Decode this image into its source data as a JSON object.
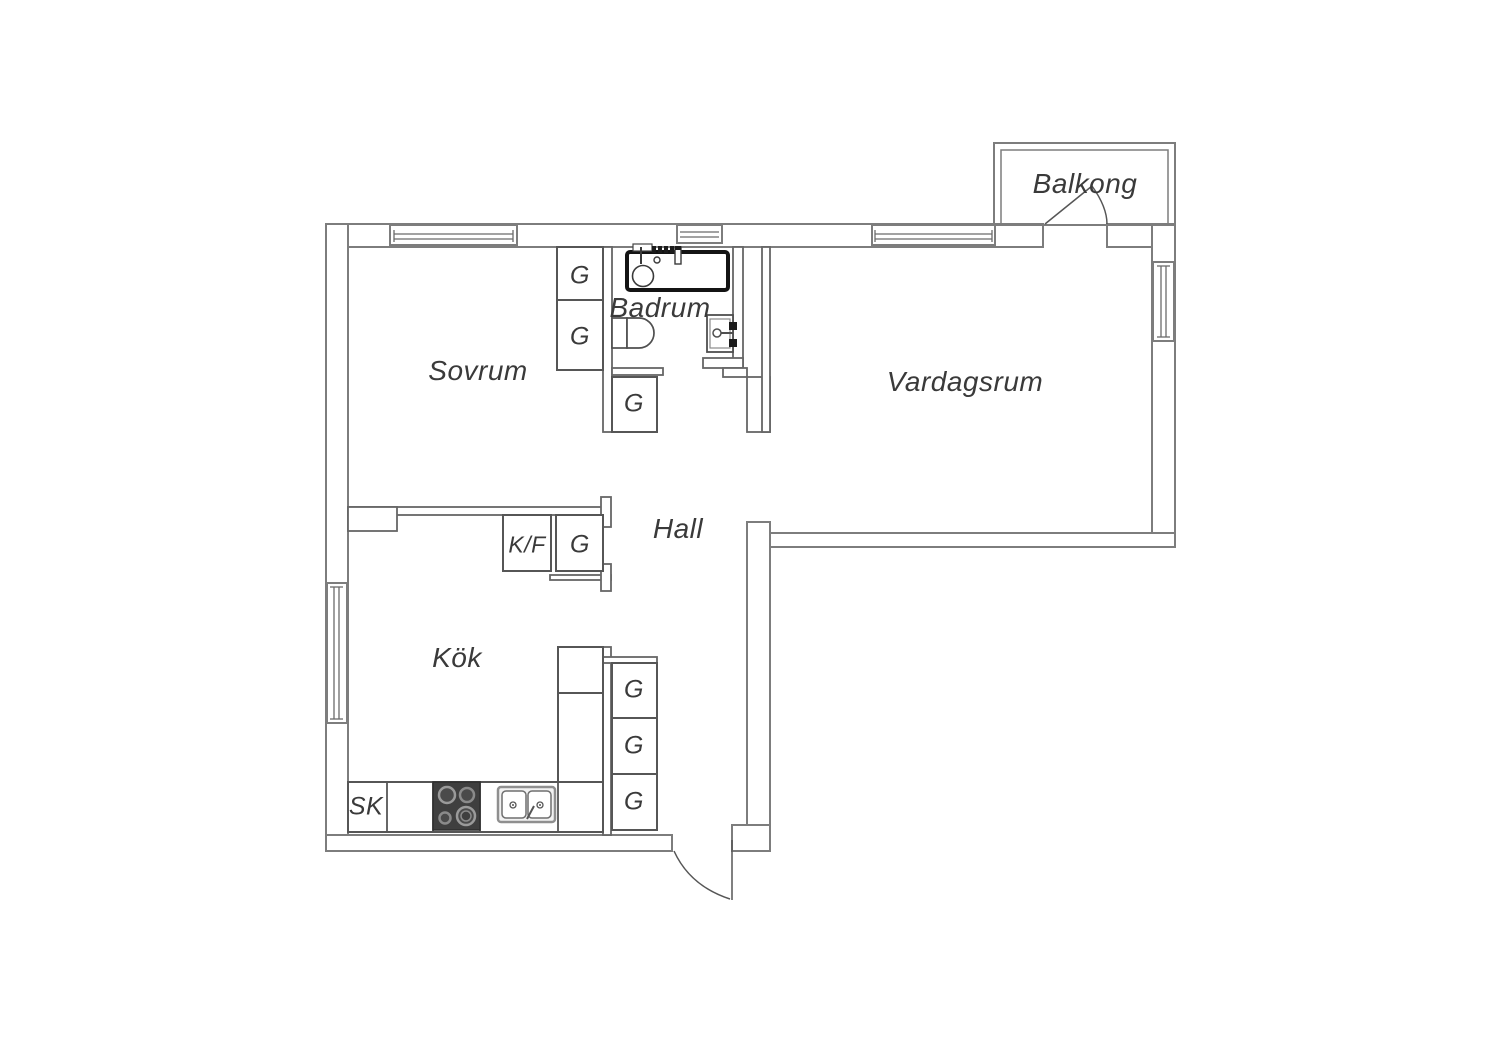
{
  "labels": {
    "bedroom": "Sovrum",
    "bathroom": "Badrum",
    "living_room": "Vardagsrum",
    "balcony": "Balkong",
    "hall": "Hall",
    "kitchen": "Kök",
    "wardrobe": "G",
    "fridge_freezer": "K/F",
    "cleaning_cabinet": "SK"
  },
  "colors": {
    "background": "#ffffff",
    "outer_wall_line": "#7d7d7d",
    "interior_line": "#565656",
    "text": "#3a3a3a",
    "stove_fill": "#3f3f3f",
    "bathtub_line": "#141414"
  }
}
